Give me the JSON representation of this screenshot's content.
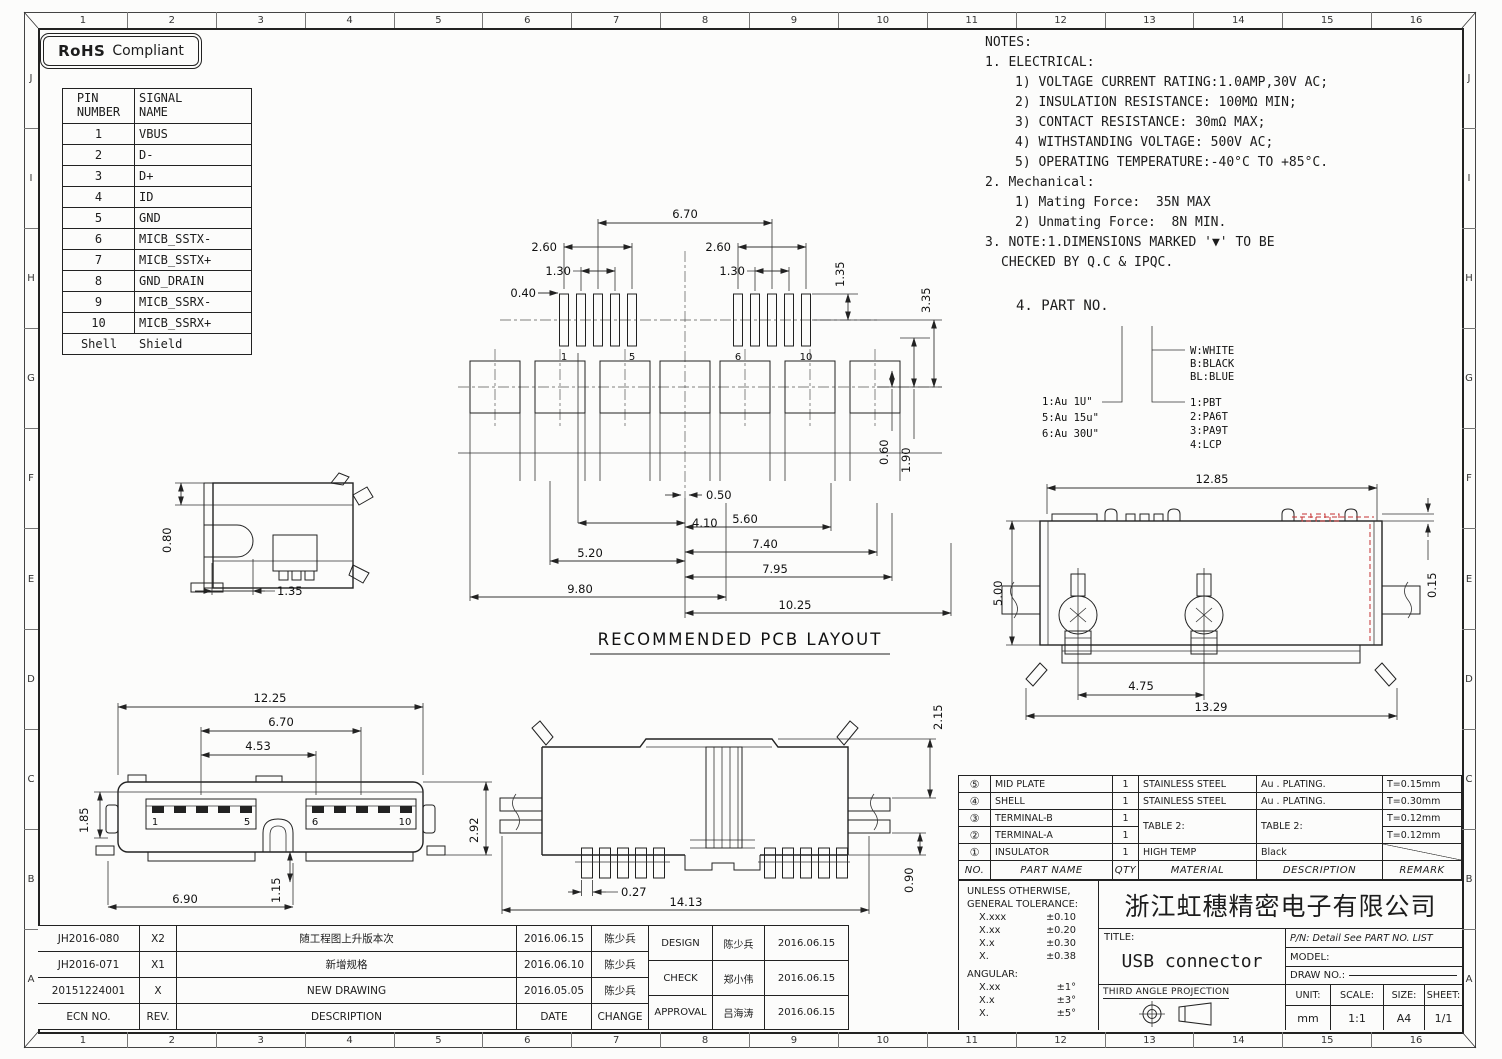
{
  "colors": {
    "ink": "#1c1c1c",
    "red": "#c53030"
  },
  "badge": {
    "bold": "RoHS",
    "rest": "Compliant"
  },
  "ruler": {
    "cols": [
      "1",
      "2",
      "3",
      "4",
      "5",
      "6",
      "7",
      "8",
      "9",
      "10",
      "11",
      "12",
      "13",
      "14",
      "15",
      "16"
    ],
    "rows": [
      "J",
      "I",
      "H",
      "G",
      "F",
      "E",
      "D",
      "C",
      "B",
      "A"
    ]
  },
  "pin_table": {
    "h_pin_1": "PIN",
    "h_pin_2": "NUMBER",
    "h_sig_1": "SIGNAL",
    "h_sig_2": "NAME",
    "rows": [
      [
        "1",
        "VBUS"
      ],
      [
        "2",
        "D-"
      ],
      [
        "3",
        "D+"
      ],
      [
        "4",
        "ID"
      ],
      [
        "5",
        "GND"
      ],
      [
        "6",
        "MICB_SSTX-"
      ],
      [
        "7",
        "MICB_SSTX+"
      ],
      [
        "8",
        "GND_DRAIN"
      ],
      [
        "9",
        "MICB_SSRX-"
      ],
      [
        "10",
        "MICB_SSRX+"
      ],
      [
        "Shell",
        "Shield"
      ]
    ]
  },
  "notes": {
    "lines": [
      "NOTES:",
      "1. ELECTRICAL:",
      "1) VOLTAGE CURRENT RATING:1.0AMP,30V AC;",
      "2) INSULATION RESISTANCE: 100MΩ MIN;",
      "3) CONTACT RESISTANCE: 30mΩ MAX;",
      "4) WITHSTANDING VOLTAGE: 500V AC;",
      "5) OPERATING TEMPERATURE:-40°C TO +85°C.",
      "2. Mechanical:",
      "1) Mating Force:  35N MAX",
      "2) Unmating Force:  8N MIN.",
      "3. NOTE:1.DIMENSIONS MARKED '▼' TO BE",
      "CHECKED BY Q.C & IPQC."
    ],
    "part_no_heading": "4. PART NO."
  },
  "part_tree": {
    "plating": [
      "1:Au 1U\"",
      "5:Au 15u\"",
      "6:Au 30U\""
    ],
    "colors": [
      "W:WHITE",
      "B:BLACK",
      "BL:BLUE"
    ],
    "materials": [
      "1:PBT",
      "2:PA6T",
      "3:PA9T",
      "4:LCP"
    ]
  },
  "views": {
    "pcb": {
      "title": "RECOMMENDED PCB LAYOUT",
      "d670": "6.70",
      "d260l": "2.60",
      "d130l": "1.30",
      "d040": "0.40",
      "d260r": "2.60",
      "d130r": "1.30",
      "d135": "1.35",
      "d335": "3.35",
      "d060": "0.60",
      "d190": "1.90",
      "d050": "0.50",
      "d410": "4.10",
      "d520": "5.20",
      "d980": "9.80",
      "d560": "5.60",
      "d740": "7.40",
      "d795": "7.95",
      "d1025": "10.25",
      "p1": "1",
      "p5": "5",
      "p6": "6",
      "p10": "10"
    },
    "side": {
      "d080": "0.80",
      "d135": "1.35"
    },
    "front": {
      "d1225": "12.25",
      "d670": "6.70",
      "d453": "4.53",
      "d185": "1.85",
      "d292": "2.92",
      "d115": "1.15",
      "d690": "6.90",
      "p1": "1",
      "p5": "5",
      "p6": "6",
      "p10": "10"
    },
    "rear": {
      "d215": "2.15",
      "d090": "0.90",
      "d027": "0.27",
      "d1413": "14.13"
    },
    "top": {
      "d1285": "12.85",
      "d500": "5.00",
      "d015": "0.15",
      "d475": "4.75",
      "d1329": "13.29"
    }
  },
  "bom": {
    "headers": [
      "NO.",
      "PART NAME",
      "QTY",
      "MATERIAL",
      "DESCRIPTION",
      "REMARK"
    ],
    "rows": [
      {
        "no": "⑤",
        "name": "MID PLATE",
        "qty": "1",
        "material": "STAINLESS STEEL",
        "desc": "Au . PLATING.",
        "remark": "T=0.15mm"
      },
      {
        "no": "④",
        "name": "SHELL",
        "qty": "1",
        "material": "STAINLESS STEEL",
        "desc": "Au . PLATING.",
        "remark": "T=0.30mm"
      },
      {
        "no": "③",
        "name": "TERMINAL-B",
        "qty": "1",
        "material": "TABLE 2:",
        "desc": "TABLE 2:",
        "remark": "T=0.12mm"
      },
      {
        "no": "②",
        "name": "TERMINAL-A",
        "qty": "1",
        "material": "",
        "desc": "",
        "remark": "T=0.12mm"
      },
      {
        "no": "①",
        "name": "INSULATOR",
        "qty": "1",
        "material": "HIGH TEMP",
        "desc": "Black",
        "remark": ""
      }
    ]
  },
  "tolerance": {
    "line1": "UNLESS OTHERWISE,",
    "line2": "GENERAL TOLERANCE:",
    "linear": [
      [
        "X.xxx",
        "±0.10"
      ],
      [
        "X.xx",
        "±0.20"
      ],
      [
        "X.x",
        "±0.30"
      ],
      [
        "X.",
        "±0.38"
      ]
    ],
    "angular_label": "ANGULAR:",
    "angular": [
      [
        "X.xx",
        "±1°"
      ],
      [
        "X.x",
        "±3°"
      ],
      [
        "X.",
        "±5°"
      ]
    ]
  },
  "title_block": {
    "company": "浙江虹穗精密电子有限公司",
    "title_label": "TITLE:",
    "title": "USB connector",
    "pn": "P/N: Detail See PART NO. LIST",
    "model_label": "MODEL:",
    "drawno_label": "DRAW NO.:",
    "projection": "THIRD ANGLE PROJECTION",
    "unit_label": "UNIT:",
    "unit": "mm",
    "scale_label": "SCALE:",
    "scale": "1:1",
    "size_label": "SIZE:",
    "size": "A4",
    "sheet_label": "SHEET:",
    "sheet": "1/1"
  },
  "revisions": {
    "rows": [
      [
        "JH2016-080",
        "X2",
        "随工程图上升版本次",
        "2016.06.15",
        "陈少兵"
      ],
      [
        "JH2016-071",
        "X1",
        "新增规格",
        "2016.06.10",
        "陈少兵"
      ],
      [
        "20151224001",
        "X",
        "NEW DRAWING",
        "2016.05.05",
        "陈少兵"
      ],
      [
        "ECN NO.",
        "REV.",
        "DESCRIPTION",
        "DATE",
        "CHANGE"
      ]
    ]
  },
  "approvals": {
    "rows": [
      [
        "DESIGN",
        "陈少兵",
        "2016.06.15"
      ],
      [
        "CHECK",
        "郑小伟",
        "2016.06.15"
      ],
      [
        "APPROVAL",
        "吕海涛",
        "2016.06.15"
      ]
    ]
  }
}
